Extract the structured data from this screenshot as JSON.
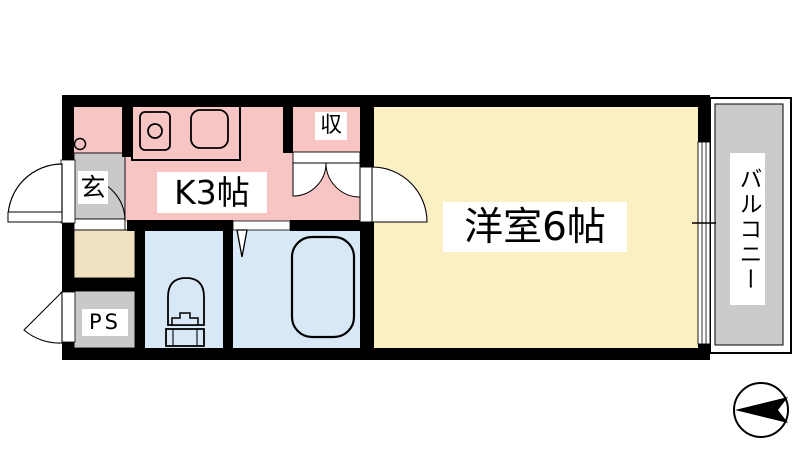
{
  "labels": {
    "kitchen": "K3帖",
    "western_room": "洋室6帖",
    "storage": "収",
    "entrance": "玄",
    "pipe_space": "PS",
    "balcony": "バルコニー"
  },
  "colors": {
    "kitchen": "#f8c5c5",
    "western_room": "#fbf0c4",
    "wet_area": "#d9e8f7",
    "entrance": "#c9c9c9",
    "pipe_space": "#c9c9c9",
    "balcony": "#cbcbcb",
    "vanity": "#f0e1c1",
    "wall": "#000000",
    "background": "#ffffff"
  },
  "icons": {
    "compass": "north-arrow-pointing-left",
    "fixtures": [
      "kitchen-sink",
      "stove-burner",
      "washing-machine-tap",
      "toilet",
      "bathtub",
      "sliding-window",
      "hinged-doors",
      "folding-bath-door",
      "double-closet-doors"
    ]
  }
}
